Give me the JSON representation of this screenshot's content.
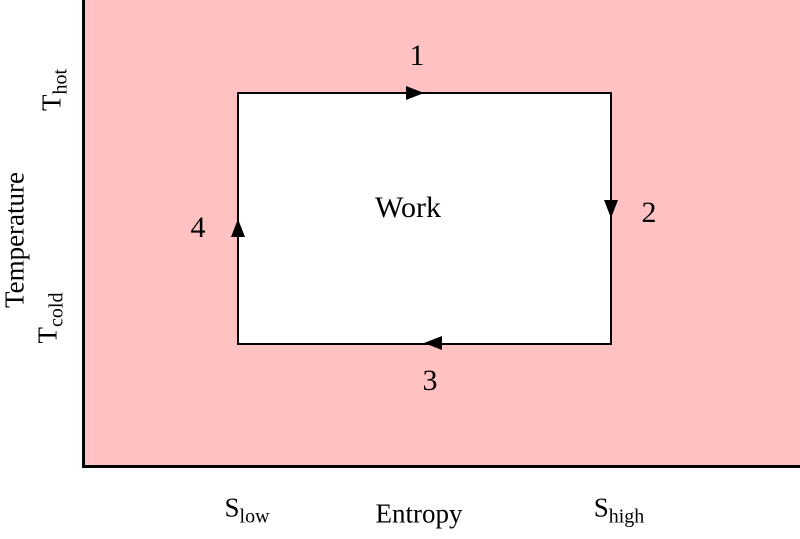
{
  "figure": {
    "description": "Carnot cycle temperature-entropy diagram",
    "colors": {
      "plot_fill": "#ffc1c1",
      "line": "#000000",
      "cycle_fill": "#ffffff",
      "background": "#ffffff"
    }
  },
  "axes": {
    "y": {
      "label": "Temperature",
      "ticks": [
        {
          "base": "T",
          "sub": "hot"
        },
        {
          "base": "T",
          "sub": "cold"
        }
      ]
    },
    "x": {
      "label": "Entropy",
      "ticks": [
        {
          "base": "S",
          "sub": "low"
        },
        {
          "base": "S",
          "sub": "high"
        }
      ]
    }
  },
  "cycle": {
    "work_label": "Work",
    "steps": [
      {
        "label": "1",
        "edge": "top",
        "direction": "right"
      },
      {
        "label": "2",
        "edge": "right",
        "direction": "down"
      },
      {
        "label": "3",
        "edge": "bottom",
        "direction": "left"
      },
      {
        "label": "4",
        "edge": "left",
        "direction": "up"
      }
    ]
  },
  "chart_data": {
    "type": "line",
    "title": "",
    "xlabel": "Entropy",
    "ylabel": "Temperature",
    "x_tick_labels": [
      "S_low",
      "S_high"
    ],
    "y_tick_labels": [
      "T_cold",
      "T_hot"
    ],
    "grid": false,
    "legend": false,
    "series": [
      {
        "name": "Carnot cycle (closed rectangular path, clockwise)",
        "points": [
          [
            "S_low",
            "T_hot"
          ],
          [
            "S_high",
            "T_hot"
          ],
          [
            "S_high",
            "T_cold"
          ],
          [
            "S_low",
            "T_cold"
          ],
          [
            "S_low",
            "T_hot"
          ]
        ],
        "segment_labels": [
          "1",
          "2",
          "3",
          "4"
        ]
      }
    ],
    "annotations": [
      {
        "text": "Work",
        "position": "center of enclosed rectangle"
      }
    ]
  }
}
